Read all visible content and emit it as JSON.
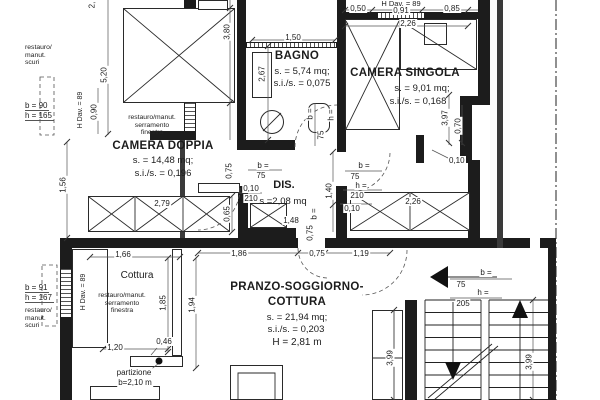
{
  "colors": {
    "line": "#1c1c1c",
    "background": "#ffffff"
  },
  "rooms": {
    "bagno": {
      "title": "BAGNO",
      "area": "s. = 5,74 mq;",
      "ratio": "s.i./s. = 0,075"
    },
    "camera_singola": {
      "title": "CAMERA SINGOLA",
      "area": "s. = 9,01 mq;",
      "ratio": "s.i./s. = 0,168"
    },
    "camera_doppia": {
      "title": "CAMERA DOPPIA",
      "area": "s. = 14,48 mq;",
      "ratio": "s.i./s. = 0,196"
    },
    "dis": {
      "title": "DIS.",
      "area": "s.=2,08 mq"
    },
    "pranzo": {
      "title_line1": "PRANZO-SOGGIORNO-",
      "title_line2": "COTTURA",
      "area": "s. = 21,94 mq;",
      "ratio": "s.i./s. = 0,203",
      "height": "H = 2,81 m"
    },
    "cottura": {
      "title": "Cottura"
    }
  },
  "windows": {
    "w1": {
      "b": "b = 90",
      "h": "h = 165",
      "dav": "H Dav. = 89",
      "width": "0,90"
    },
    "w2": {
      "b": "b = 91",
      "h": "h = 167",
      "dav": "H Dav. = 89"
    },
    "w3": {
      "dav": "H Dav. = 89"
    }
  },
  "doors": {
    "doppia": {
      "b": "b =",
      "bv": "75",
      "w": "0,75",
      "t": "0,10",
      "hv": "210"
    },
    "bagno": {
      "b": "b =",
      "bv": "75",
      "h": "h ="
    },
    "singola": {
      "b": "b =",
      "bv": "75",
      "h": "h =",
      "hv": "210",
      "t": "0,10",
      "off": "1,40"
    },
    "pranzo": {
      "b": "b =",
      "w": "0,75"
    },
    "stairs": {
      "b": "b =",
      "bv": "75",
      "h": "h =",
      "hv": "205",
      "t": "0,10"
    }
  },
  "notes": {
    "scuri_top": [
      "restauro/",
      "manut.",
      "scuri"
    ],
    "finestra_top": [
      "restauro/manut.",
      "serramento",
      "finestra"
    ],
    "scuri_bottom": [
      "restauro/",
      "manut.",
      "scuri"
    ],
    "finestra_bottom": [
      "restauro/manut.",
      "serramento",
      "finestra"
    ],
    "partizione_1": "partizione",
    "partizione_2": "b=2,10 m"
  },
  "dims": {
    "cut": "2,",
    "v520": "5,20",
    "v380": "3,80",
    "v267": "2,67",
    "h150": "1,50",
    "h050": "0,50",
    "h091": "0,91",
    "h085": "0,85",
    "h226": "2,26",
    "v397": "3,97",
    "v070": "0,70",
    "v156": "1,56",
    "w279": "2,79",
    "v065": "0,65",
    "w148": "1,48",
    "w226": "2,26",
    "h186": "1,86",
    "h075": "0,75",
    "h119": "1,19",
    "h166": "1,66",
    "v185": "1,85",
    "v194": "1,94",
    "h120": "1,20",
    "h046": "0,46",
    "v399a": "3,99",
    "v399b": "3,99"
  }
}
